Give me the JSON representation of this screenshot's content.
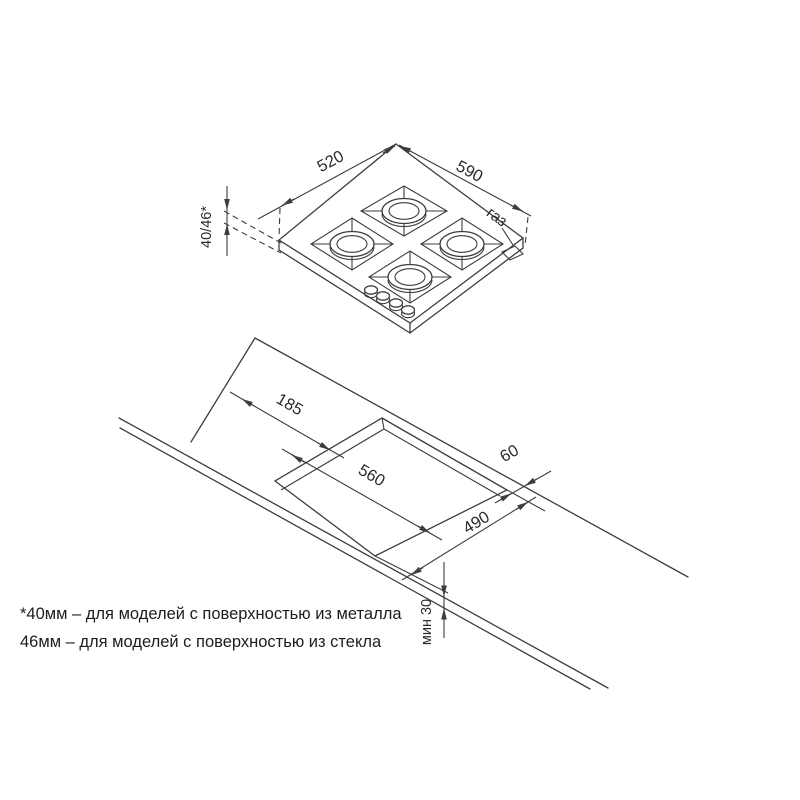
{
  "diagram": {
    "hob": {
      "dim_left_edge": "520",
      "dim_right_edge": "590",
      "dim_height": "40/46*",
      "gas_label": "газ"
    },
    "cutout": {
      "dim_offset_left": "185",
      "dim_length": "560",
      "dim_back_gap": "60",
      "dim_width": "490",
      "dim_min_front": "мин 30"
    },
    "footnote": {
      "line1": "*40мм – для моделей с поверхностью из металла",
      "line2": "46мм – для моделей с поверхностью из стекла"
    },
    "colors": {
      "line": "#3d3d3d",
      "text": "#2b2b2b",
      "background": "#ffffff"
    }
  }
}
